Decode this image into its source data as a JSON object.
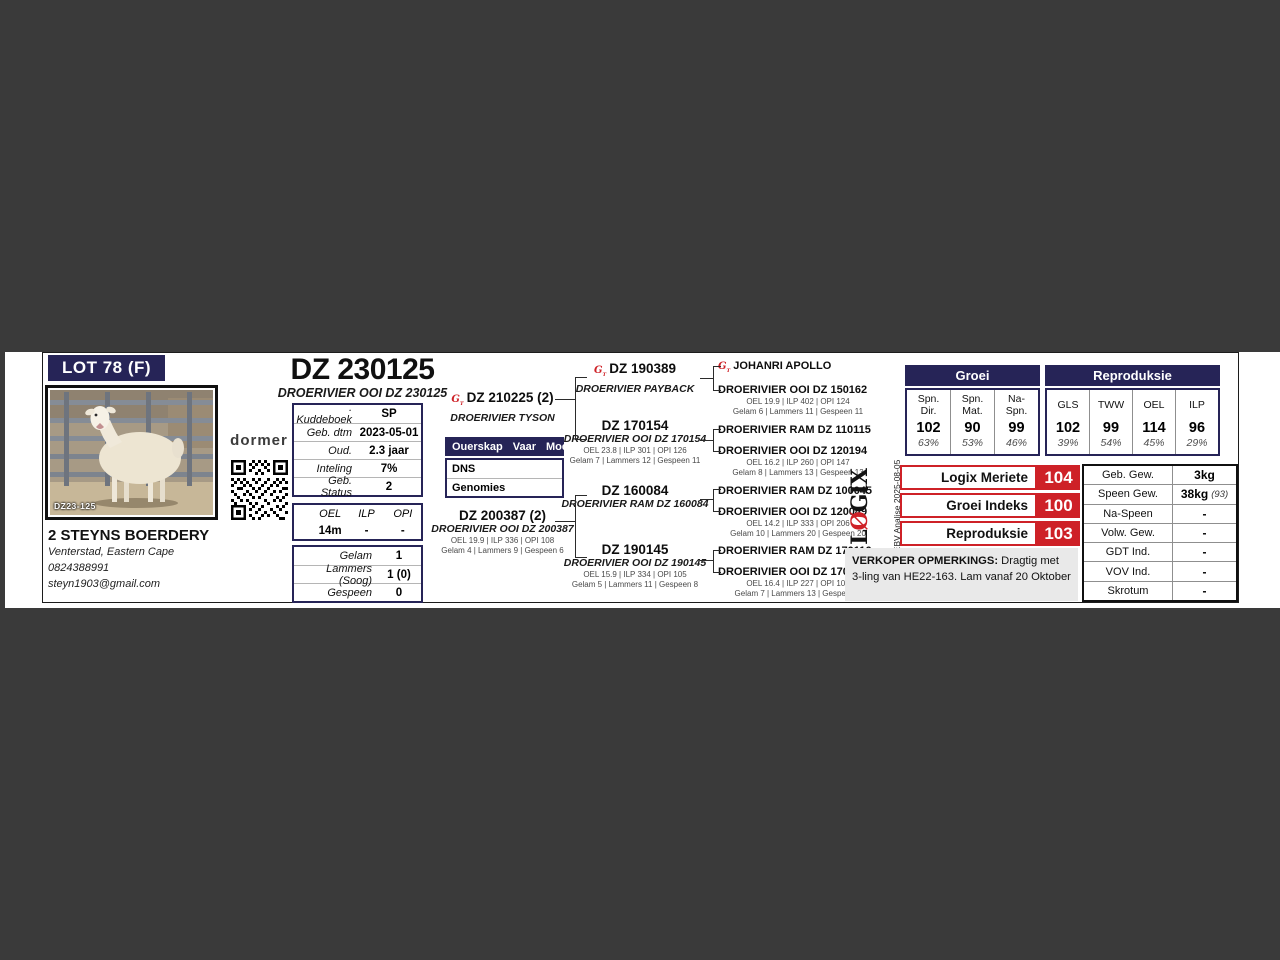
{
  "lot": {
    "badge": "LOT 78 (F)"
  },
  "photo": {
    "tag": "DZ23-125"
  },
  "brand": {
    "logo": "dormer"
  },
  "breeder": {
    "name": "2 STEYNS BOERDERY",
    "location": "Venterstad, Eastern Cape",
    "phone": "0824388991",
    "email": "steyn1903@gmail.com"
  },
  "animal": {
    "id": "DZ 230125",
    "full_name": "DROERIVIER OOI DZ 230125"
  },
  "info_table": {
    "rows": [
      {
        "label": ". Kuddeboek",
        "value": "SP"
      },
      {
        "label": "Geb. dtm",
        "value": "2023-05-01"
      },
      {
        "label": "Oud.",
        "value": "2.3 jaar"
      },
      {
        "label": "Inteling",
        "value": "7%"
      },
      {
        "label": "Geb. Status",
        "value": "2"
      }
    ]
  },
  "oel_table": {
    "headers": [
      "OEL",
      "ILP",
      "OPI"
    ],
    "values": [
      "14m",
      "-",
      "-"
    ]
  },
  "lamb_table": {
    "rows": [
      {
        "label": "Gelam",
        "value": "1"
      },
      {
        "label": "Lammers (Soog)",
        "value": "1 (0)"
      },
      {
        "label": "Gespeen",
        "value": "0"
      }
    ]
  },
  "ouerskap": {
    "title": "Ouerskap",
    "col1": "Vaar",
    "col2": "Moer",
    "rows": [
      "DNS",
      "Genomies"
    ]
  },
  "pedigree": {
    "sire": {
      "id": "DZ 210225 (2)",
      "name": "DROERIVIER TYSON"
    },
    "dam": {
      "id": "DZ 200387 (2)",
      "name": "DROERIVIER OOI DZ 200387",
      "stats1": "OEL 19.9 | ILP 336 | OPI 108",
      "stats2": "Gelam 4 | Lammers 9 | Gespeen 6"
    },
    "gen2": [
      {
        "id": "DZ 190389",
        "name": "DROERIVIER PAYBACK"
      },
      {
        "id": "DZ 170154",
        "name": "DROERIVIER OOI DZ 170154",
        "stats1": "OEL 23.8 | ILP 301 | OPI 126",
        "stats2": "Gelam 7 | Lammers 12 | Gespeen 11"
      },
      {
        "id": "DZ 160084",
        "name": "DROERIVIER RAM DZ 160084"
      },
      {
        "id": "DZ 190145",
        "name": "DROERIVIER OOI DZ 190145",
        "stats1": "OEL 15.9 | ILP 334 | OPI 105",
        "stats2": "Gelam 5 | Lammers 11 | Gespeen 8"
      }
    ],
    "gen3": [
      {
        "name": "JOHANRI APOLLO"
      },
      {
        "name": "DROERIVIER OOI DZ 150162",
        "stats1": "OEL 19.9 | ILP 402 | OPI 124",
        "stats2": "Gelam 6 | Lammers 11 | Gespeen 11"
      },
      {
        "name": "DROERIVIER RAM DZ 110115"
      },
      {
        "name": "DROERIVIER OOI DZ 120194",
        "stats1": "OEL 16.2 | ILP 260 | OPI 147",
        "stats2": "Gelam 8 | Lammers 13 | Gespeen 13"
      },
      {
        "name": "DROERIVIER RAM DZ 100045"
      },
      {
        "name": "DROERIVIER OOI DZ 120049",
        "stats1": "OEL 14.2 | ILP 333 | OPI 206",
        "stats2": "Gelam 10 | Lammers 20 | Gespeen 20"
      },
      {
        "name": "DROERIVIER RAM DZ 170116"
      },
      {
        "name": "DROERIVIER OOI DZ 170124",
        "stats1": "OEL 16.4 | ILP 227 | OPI 100",
        "stats2": "Gelam 7 | Lammers 13 | Gespeen 8"
      }
    ]
  },
  "ebv": {
    "groups": {
      "groei": "Groei",
      "repro": "Reproduksie"
    },
    "columns": [
      {
        "header": "Spn.\nDir.",
        "value": "102",
        "acc": "63%"
      },
      {
        "header": "Spn.\nMat.",
        "value": "90",
        "acc": "53%"
      },
      {
        "header": "Na-\nSpn.",
        "value": "99",
        "acc": "46%"
      },
      {
        "header": "GLS",
        "value": "102",
        "acc": "39%"
      },
      {
        "header": "TWW",
        "value": "99",
        "acc": "54%"
      },
      {
        "header": "OEL",
        "value": "114",
        "acc": "45%"
      },
      {
        "header": "ILP",
        "value": "96",
        "acc": "29%"
      }
    ]
  },
  "logix": {
    "l": "L",
    "o": "Ø",
    "gix": "GIX",
    "analysis": "EBV Analise 2025-08-05"
  },
  "indexes": [
    {
      "label": "Logix Meriete Indeks",
      "value": "104"
    },
    {
      "label": "Groei Indeks",
      "value": "100"
    },
    {
      "label": "Reproduksie Indeks",
      "value": "103"
    }
  ],
  "remarks": {
    "title": "VERKOPER OPMERKINGS:",
    "text": " Dragtig met 3-ling van HE22-163. Lam vanaf 20 Oktober"
  },
  "weights": {
    "rows": [
      {
        "label": "Geb. Gew.",
        "value": "3kg",
        "note": ""
      },
      {
        "label": "Speen Gew.",
        "value": "38kg",
        "note": "(93)"
      },
      {
        "label": "Na-Speen",
        "value": "-",
        "note": ""
      },
      {
        "label": "Volw. Gew.",
        "value": "-",
        "note": ""
      },
      {
        "label": "GDT Ind.",
        "value": "-",
        "note": ""
      },
      {
        "label": "VOV Ind.",
        "value": "-",
        "note": ""
      },
      {
        "label": "Skrotum",
        "value": "-",
        "note": ""
      }
    ]
  },
  "colors": {
    "navy": "#262457",
    "red": "#ce2127",
    "viewer_bg": "#3a3a3a"
  }
}
